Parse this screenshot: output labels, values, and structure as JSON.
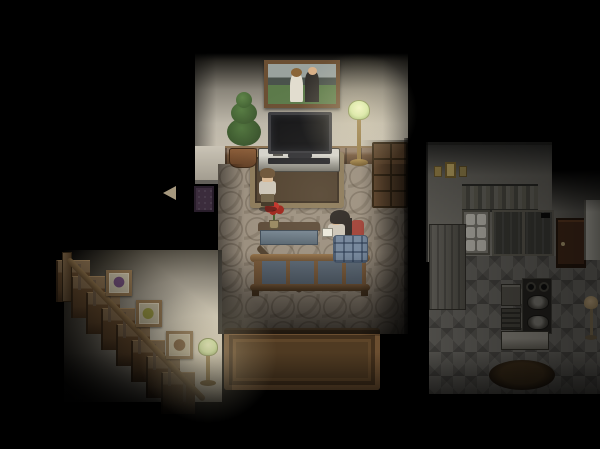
{
  "scene": {
    "title": "dark-house-interior-night",
    "type": "top-down-pixel-rpg-horror",
    "lighting": "two lamp light pools in darkness",
    "rooms": [
      {
        "name": "living-bedroom",
        "objects": [
          "family-portrait-painting",
          "potted-plant",
          "flat-screen-tv",
          "tv-console",
          "green-glass-floor-lamp",
          "wood-dresser",
          "area-rug",
          "red-flower-vase",
          "sofa-bench",
          "wood-frame-bed-with-blue-panels",
          "large-wood-table"
        ]
      },
      {
        "name": "stairwell",
        "objects": [
          "diagonal-staircase",
          "banister-rail",
          "picture-frame-purple-flower",
          "picture-frame-yellow-flower",
          "picture-frame-teddy-bear",
          "small-green-floor-lamp",
          "doormat",
          "left-arrow-event-indicator"
        ]
      },
      {
        "name": "kitchen",
        "objects": [
          "wall-decorations",
          "striped-curtain",
          "dish-shelf",
          "dark-china-hutch",
          "tall-gray-cabinet",
          "brown-wood-door",
          "white-refrigerator",
          "stove-with-two-pots",
          "sink-unit",
          "lower-grill-cabinet",
          "white-counter",
          "round-dark-table",
          "standing-lamp"
        ]
      }
    ],
    "characters": [
      {
        "name": "boy-standing",
        "pose": "standing on rug below tv, facing down",
        "hair": "brown",
        "outfit": "pale shirt, dark pants"
      },
      {
        "name": "girl-reading",
        "pose": "sitting in bed under plaid blanket holding book",
        "hair": "long black",
        "props": [
          "white book",
          "red pillow"
        ]
      }
    ]
  },
  "colors": {
    "bg": "#000000",
    "bedroomWallLight": "#c4bdae",
    "wainscot": "#6e5138",
    "carpet": "#9a8e7e",
    "rugCenter": "#4e3e2c",
    "rugBorder": "#8a7858",
    "bedPanel": "#5b6876",
    "blanket": "#72849a",
    "pillowRed": "#a04036",
    "flowerRed": "#bf2d24",
    "lampGlass": "#cfe6a0",
    "lampBrass": "#8f7440",
    "glow": "rgba(255,241,199,0.32)",
    "kitchenWall": "#8b887f",
    "kitchenFloor": "#72706a",
    "doorBrown": "#4c2f1d",
    "hutchDark": "#44443e",
    "stairWood": "#8a7050",
    "stairWallLight": "#ddd5c3",
    "hairBoy": "#6b5236",
    "hairGirl": "#2a2522",
    "skin": "#d9b894",
    "shirt": "#ccc5b8",
    "framePurple": "#6a4a72",
    "frameOlive": "#8f8d3f",
    "frameBrown": "#7a5a38",
    "paintingSky": "#9aa29e",
    "paintingMountain": "#4a524c",
    "paintingField": "#5c7a4a"
  }
}
